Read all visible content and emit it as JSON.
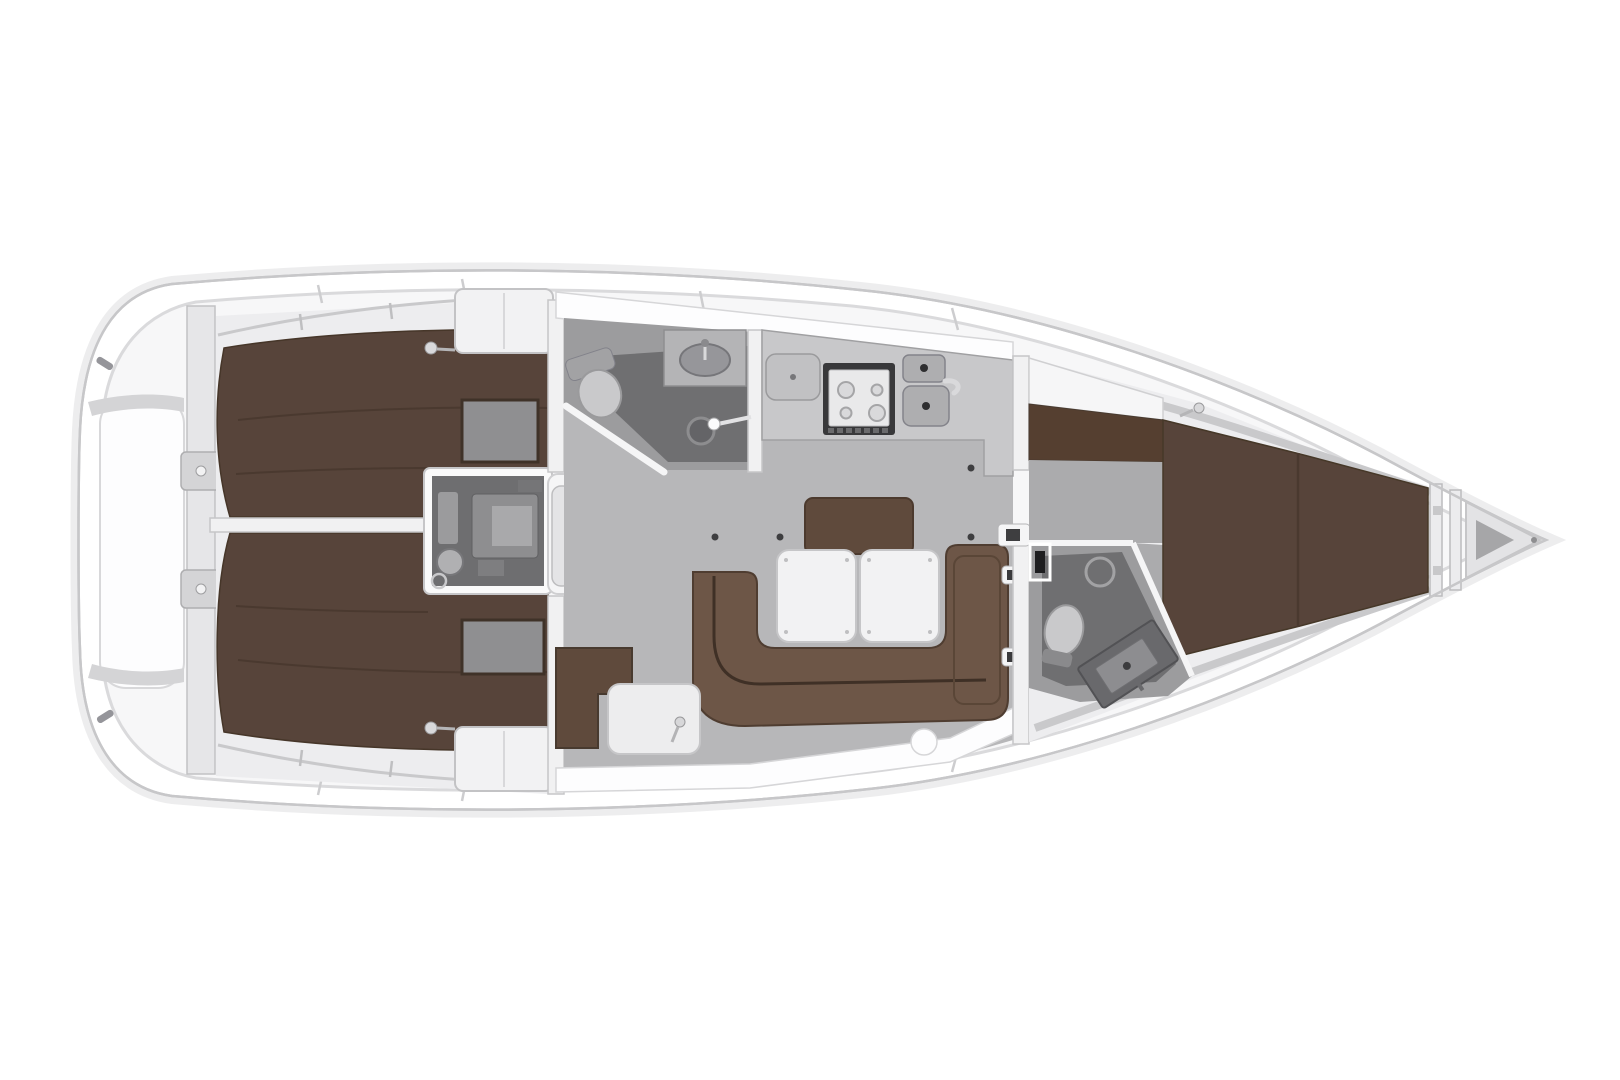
{
  "meta": {
    "title": "Sailing yacht interior layout plan, top view, bow pointing right",
    "diagram_type": "boat-floor-plan"
  },
  "palette": {
    "pageBg": "#ffffff",
    "hull": "#ffffff",
    "hullLine": "#c7c7c9",
    "hullGlow": "#ededee",
    "linerFill": "#f7f7f8",
    "linerLine": "#dadadc",
    "deckWhite": "#fdfdfe",
    "deckEdge": "#d6d6d8",
    "cabinBase": "#ededef",
    "wall": "#f1f1f2",
    "wallEdge": "#c6c6c8",
    "berth": "#57443a",
    "berthDark": "#3f3228",
    "seam": "#4a392f",
    "insetGray": "#8f8f91",
    "wardrobe": "#f2f2f3",
    "salonFloor": "#b7b7b9",
    "headFloor": "#9c9c9e",
    "showerFloor": "#6f6f71",
    "engineFloor": "#6e6e70",
    "enginePart": "#8e8e90",
    "enginePartLight": "#a9a9ab",
    "step": "#e4e4e6",
    "stepEdge": "#bdbdbf",
    "counter": "#c8c8ca",
    "counterEdge": "#a0a0a2",
    "stoveFrame": "#38383a",
    "panelLight": "#e9e9ea",
    "metal": "#aeaeb0",
    "metalEdge": "#83838a",
    "drain": "#2e2e30",
    "sofa": "#6d5647",
    "sofaSeam": "#3f3026",
    "bench": "#5f4a3c",
    "tableWhite": "#f2f2f3",
    "tableEdge": "#c6c6c8",
    "fixture": "#c9c9cb",
    "fixtureEdge": "#9a9a9c",
    "fixtureMid": "#a2a2a4",
    "chrome": "#d9d9db",
    "dot": "#3e3e40",
    "dresser": "#553f30",
    "fwdFloor": "#ababad",
    "vanity": "#69696c",
    "vanityPanel": "#8d8d90",
    "anchorDark": "#a6a6a8",
    "darkFrame": "#1e1e20",
    "stripGray": "#d4d4d6",
    "hardwareGray": "#95959a"
  },
  "regions": {
    "hull": {
      "label": "yacht hull, deck plan outline"
    },
    "stern": {
      "label": "stern with swim platform and transom lockers"
    },
    "aft_cabin_top": {
      "label": "aft cabin with double berth, starboard"
    },
    "aft_cabin_bottom": {
      "label": "aft cabin with double berth, port"
    },
    "engine": {
      "label": "engine compartment"
    },
    "companionway": {
      "label": "companionway steps"
    },
    "aft_head": {
      "label": "aft head with toilet, washbasin and shower"
    },
    "galley": {
      "label": "galley with stove, fridge and twin sinks"
    },
    "salon": {
      "label": "salon with U-shaped sofa and folding table"
    },
    "nav_station": {
      "label": "navigation seat and chart table"
    },
    "fwd_head": {
      "label": "forward head with toilet and vanity"
    },
    "fwd_cabin": {
      "label": "forward cabin with V-berth"
    },
    "bow": {
      "label": "bow anchor locker"
    }
  }
}
